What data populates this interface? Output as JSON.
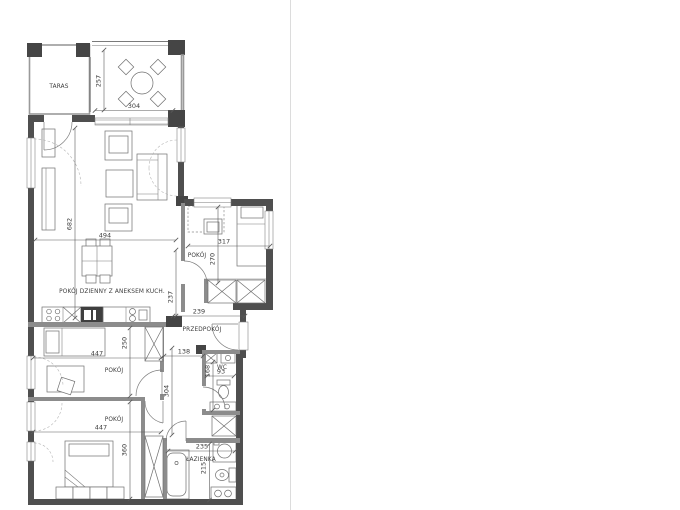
{
  "plan": {
    "rooms": {
      "taras": {
        "label": "TARAS"
      },
      "living": {
        "label": "POKÓJ DZIENNY Z ANEKSEM KUCH."
      },
      "bedroom_right": {
        "label": "POKÓJ"
      },
      "hall": {
        "label": "PRZEDPOKÓJ"
      },
      "wc": {
        "label": "WC"
      },
      "bedroom_middle": {
        "label": "POKÓJ"
      },
      "bedroom_bottom": {
        "label": "POKÓJ"
      },
      "bathroom": {
        "label": "ŁAZIENKA"
      }
    },
    "dims": {
      "terrace_depth": "257",
      "terrace_width": "304",
      "living_length": "682",
      "living_width": "494",
      "bedroom_right_width": "317",
      "bedroom_right_depth": "270",
      "hall_depth": "237",
      "hall_width": "239",
      "passage_width": "138",
      "corridor_length": "304",
      "wc_depth": "168",
      "wc_width": "93",
      "bedroom_middle_width": "447",
      "bedroom_middle_depth": "250",
      "bedroom_bottom_width": "447",
      "bedroom_bottom_depth": "360",
      "bathroom_width": "235",
      "bathroom_depth": "215"
    },
    "colors": {
      "wall": "#4f4f4f",
      "partition": "#8c8c8c",
      "furniture_line": "#6f6f6f",
      "text": "#3c3c3c",
      "background": "#ffffff"
    }
  }
}
